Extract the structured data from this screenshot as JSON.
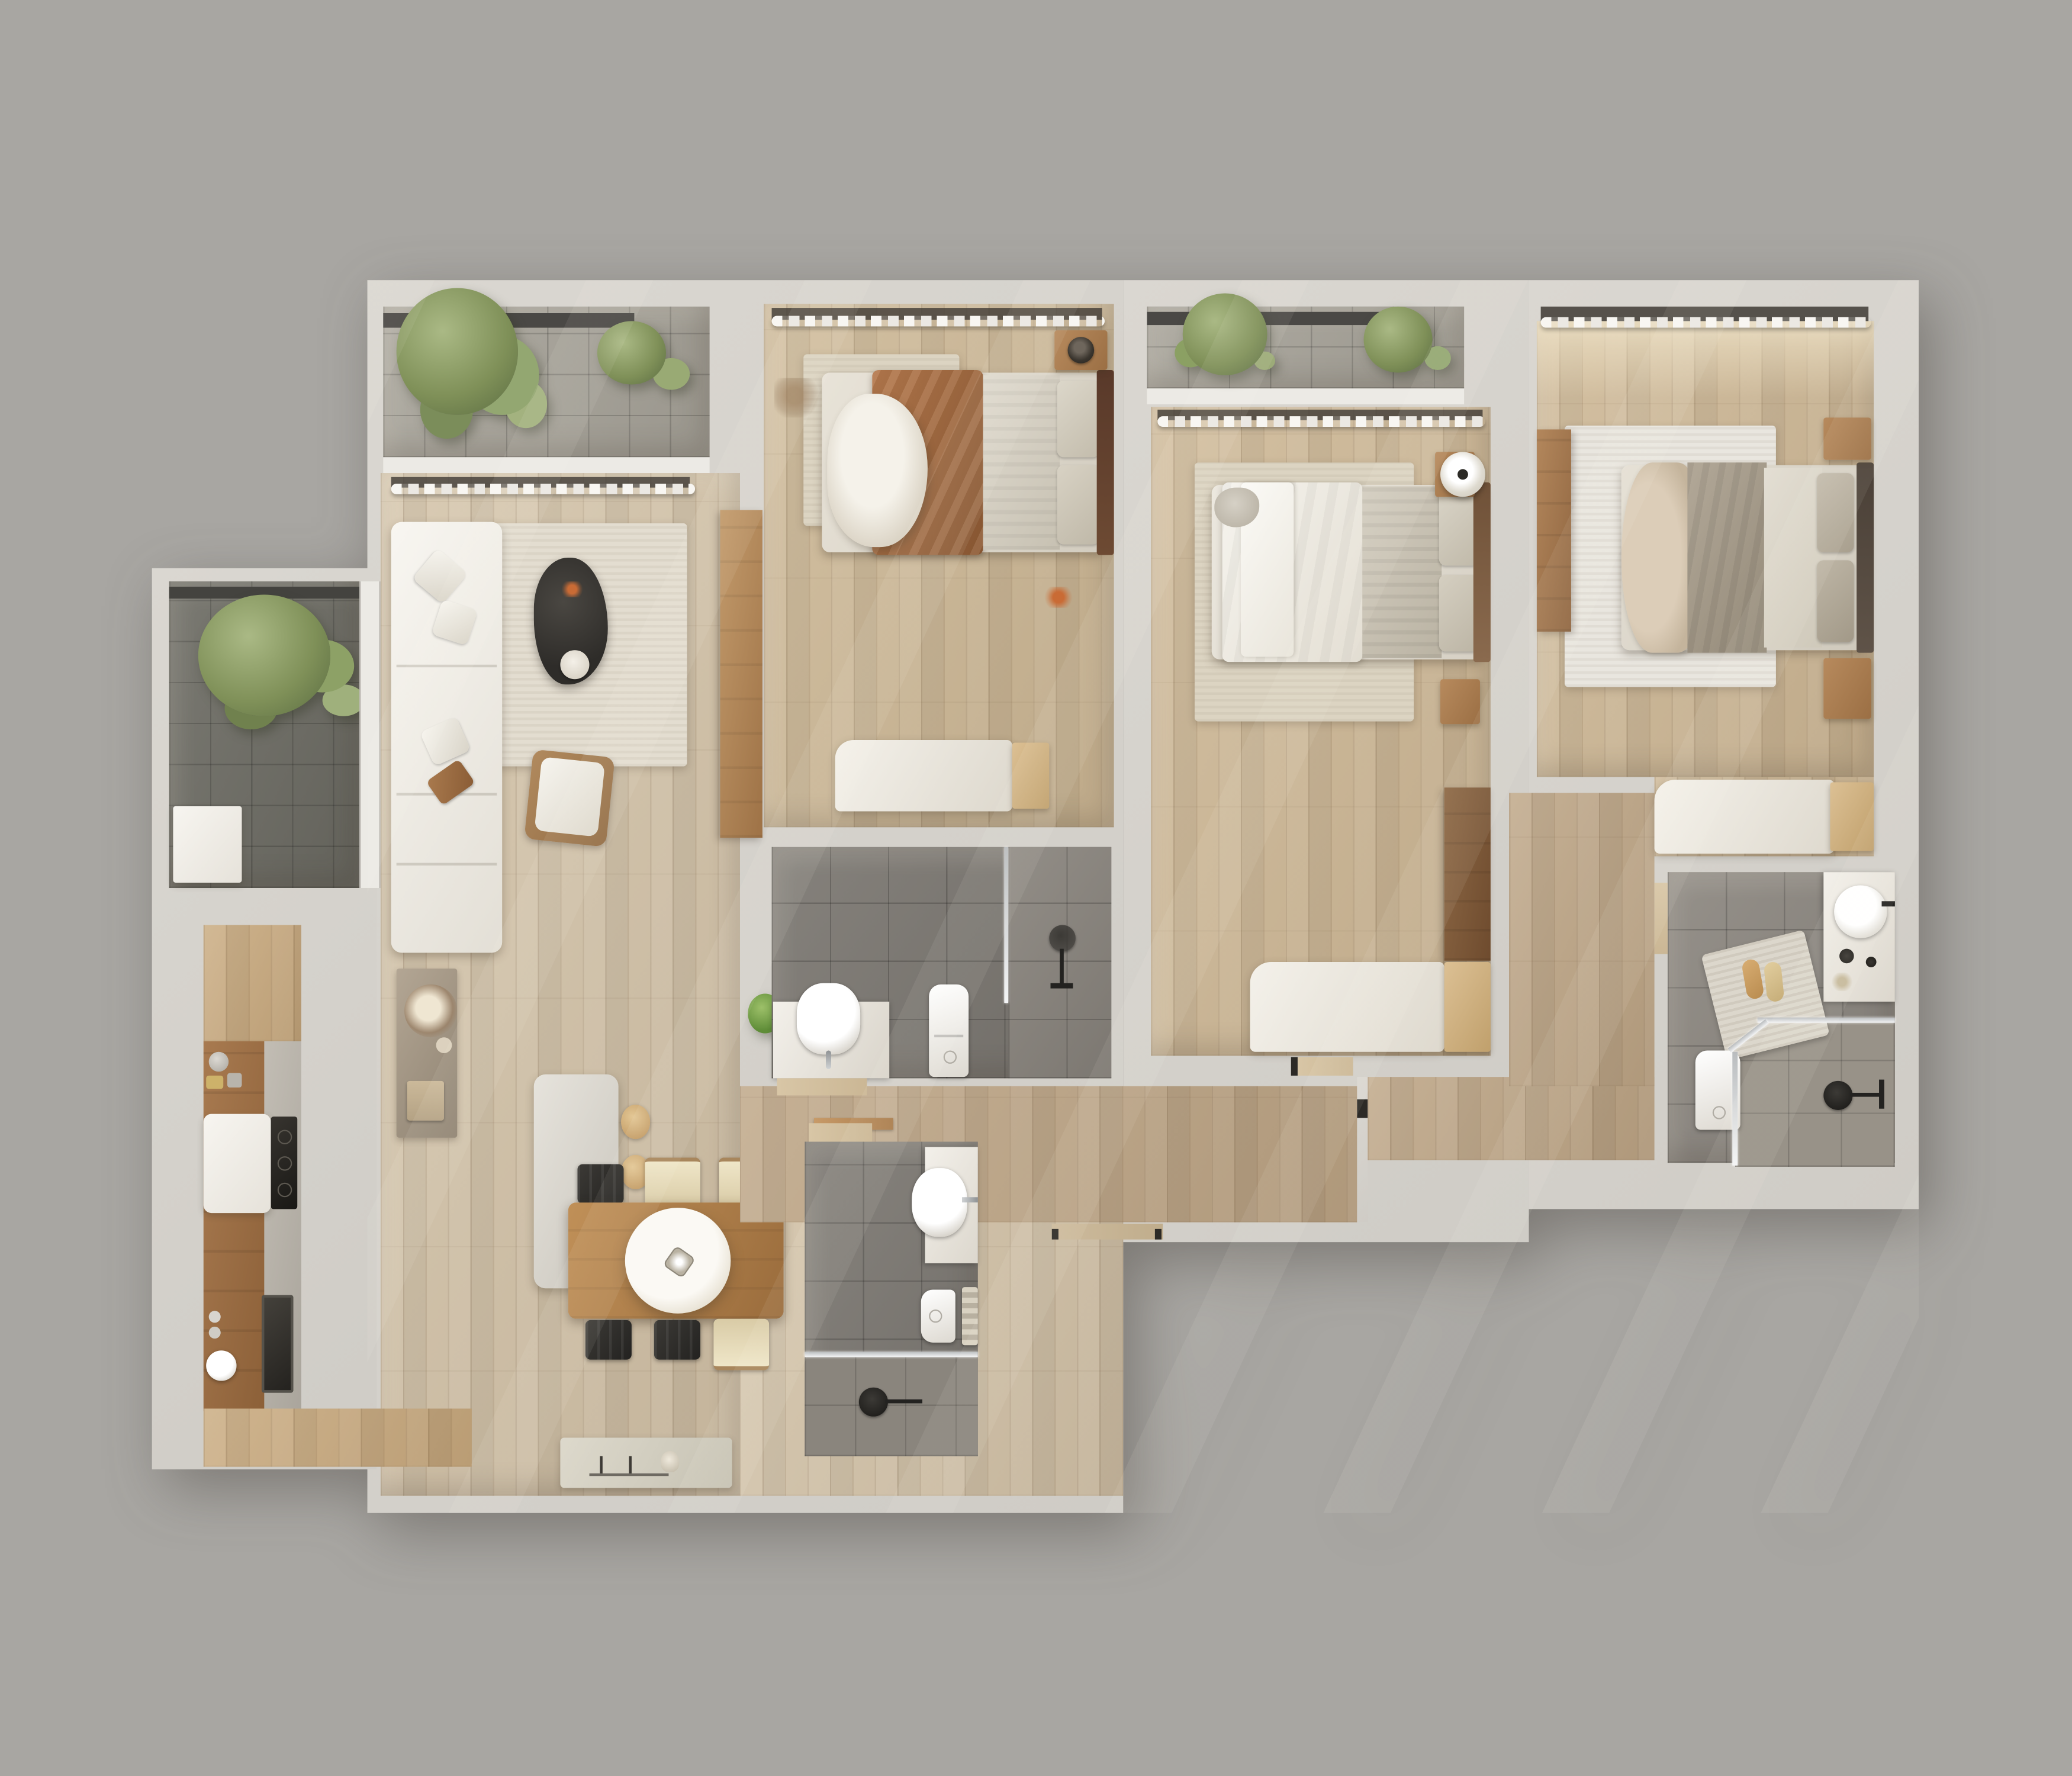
{
  "title": "3D rendered apartment floor plan – top view",
  "scene": "photoreal top-down architectural render, no visible text or labels",
  "palette": {
    "background": "#a8a6a2",
    "wall": "#d6d3cd",
    "window_sill": "#eceae5",
    "wood_floor_living": "#d3c3a9",
    "wood_floor_bedroom": "#ccb795",
    "wood_floor_corridor": "#bca485",
    "balcony_tile_light": "#a7a399",
    "balcony_tile_dark": "#6b6a62",
    "bathroom_tile_shared": "#7c7872",
    "bathroom_tile_ensuite": "#8d8881",
    "bathroom_tile_lower": "#7e7a74",
    "marble": "#f0ede8",
    "walnut_furniture": "#9b6f48",
    "duvet_brown": "#a26a42",
    "blanket_grey": "#c9c2b6",
    "rug_cream": "#e3ddd0",
    "plant_green": "#8ea06b",
    "accent_black": "#35332f",
    "stool_tan": "#cfa26a"
  },
  "rooms": [
    {
      "id": "balcony-top-left",
      "label": "Balcony with olive trees and light grey tiles"
    },
    {
      "id": "balcony-left",
      "label": "Dark tiled balcony with large plant and white table"
    },
    {
      "id": "balcony-bedroom-2",
      "label": "Balcony with planters above bedroom 2"
    },
    {
      "id": "living-room",
      "label": "Living room with white sectional sofa, cream rug, black organic coffee table, armchair and console"
    },
    {
      "id": "kitchen",
      "label": "Kitchen wing with walnut counter, cooktop, oven, sink and island with two stools"
    },
    {
      "id": "dining-area",
      "label": "Dining area with wooden table, six chairs, pendant lamp and sideboard"
    },
    {
      "id": "bedroom-1",
      "label": "Bedroom with brown and white bedding, rug, nightstand, vanity desk"
    },
    {
      "id": "bathroom-1",
      "label": "Shared bathroom with vanity sink, toilet and glass shower"
    },
    {
      "id": "bedroom-2",
      "label": "Bedroom with white and grey bedding, disc lamp, wardrobe and white desk"
    },
    {
      "id": "bedroom-3",
      "label": "Bedroom with taupe bedding, white rug, wardrobe, nightstands and desk"
    },
    {
      "id": "bathroom-ensuite",
      "label": "Ensuite bathroom with round basin, bath mat with slippers, toilet and corner shower"
    },
    {
      "id": "bathroom-lower",
      "label": "Lower bathroom with oval basin, toilet, towel rail and shower"
    },
    {
      "id": "hallway",
      "label": "L-shaped hallway connecting bedrooms and bathrooms"
    }
  ],
  "furniture_counts": {
    "beds": 3,
    "sofas": 1,
    "dining_chairs": 6,
    "stools": 2,
    "toilets": 3,
    "sinks": 4,
    "showers": 3,
    "plants": 7,
    "rugs": 4,
    "pendant_lamps": 1
  }
}
